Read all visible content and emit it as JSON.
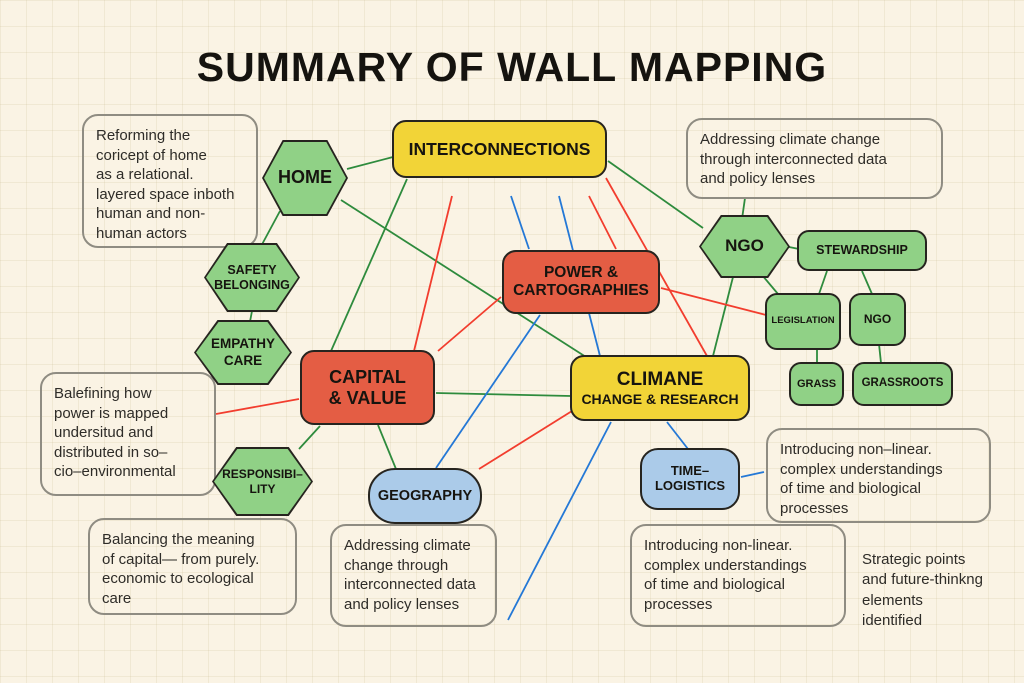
{
  "title": "SUMMARY OF WALL MAPPING",
  "colors": {
    "background": "#faf3e4",
    "node_yellow": "#f2d437",
    "node_red": "#e45d44",
    "node_green": "#90d186",
    "node_blue": "#abcbe9",
    "line_green": "#2e8b3d",
    "line_red": "#f23d2e",
    "line_blue": "#2478d6",
    "note_border": "#8f8c82",
    "text": "#16140f"
  },
  "nodes": {
    "interconnections": {
      "label": "INTERCONNECTIONS",
      "type": "yellow"
    },
    "home": {
      "label": "HOME",
      "type": "green-hexagon"
    },
    "safety_belonging": {
      "label": "SAFETY\nBELONGING",
      "type": "green-hexagon"
    },
    "empathy_care": {
      "label": "EMPATHY\nCARE",
      "type": "green-hexagon"
    },
    "ngo": {
      "label": "NGO",
      "type": "green-hexagon"
    },
    "responsibility": {
      "label": "RESPONSIBI–\nLITY",
      "type": "green-hexagon"
    },
    "power_cartographies": {
      "label": "POWER &\nCARTOGRAPHIES",
      "type": "red"
    },
    "capital_value": {
      "label": "CAPITAL\n& VALUE",
      "type": "red"
    },
    "climane": {
      "label": "CLIMANE",
      "sublabel": "CHANGE & RESEARCH",
      "type": "yellow"
    },
    "stewardship": {
      "label": "STEWARDSHIP",
      "type": "green-rect"
    },
    "legislation": {
      "label": "LEGISLATION",
      "type": "green-rect"
    },
    "ngo_small": {
      "label": "NGO",
      "type": "green-rect"
    },
    "grass": {
      "label": "GRASS",
      "type": "green-rect"
    },
    "grassroots": {
      "label": "GRASSROOTS",
      "type": "green-rect"
    },
    "geography": {
      "label": "GEOGRAPHY",
      "type": "blue"
    },
    "time_logistics": {
      "label": "TIME–\nLOGISTICS",
      "type": "blue"
    }
  },
  "notes": {
    "reforming": {
      "text": "Reforming the\ncoricept of home\nas a relational.\nlayered space inboth\nhuman and non-\nhuman actors"
    },
    "addressing_top": {
      "text": "Addressing climate change\nthrough interconnected data\nand policy lenses"
    },
    "balefining": {
      "text": "Balefining how\npower is mapped\nundersitud  and\ndistributed in so–\ncio–environmental"
    },
    "balancing": {
      "text": "Balancing the meaning\nof capital— from purely.\neconomic to ecological\ncare"
    },
    "addressing_bottom": {
      "text": "Addressing climate\nchange through\ninterconnected data\nand policy lenses"
    },
    "introducing_right": {
      "text": "Introducing non–linear.\ncomplex understandings\nof time and biological\nprocesses"
    },
    "introducing_bottom": {
      "text": "Introducing non-linear.\ncomplex understandings\nof time and biological\nprocesses"
    },
    "strategic": {
      "text": "Strategic points\nand future-thinkng\nelements\nidentified"
    }
  },
  "edges": [
    {
      "from": "home",
      "to": "interconnections",
      "color": "green",
      "x1": 347,
      "y1": 169,
      "x2": 393,
      "y2": 157
    },
    {
      "from": "home",
      "to": "safety_belonging",
      "color": "green",
      "x1": 280,
      "y1": 211,
      "x2": 259,
      "y2": 250
    },
    {
      "from": "safety_belonging",
      "to": "empathy_care",
      "color": "green",
      "x1": 252,
      "y1": 311,
      "x2": 249,
      "y2": 327
    },
    {
      "from": "home",
      "to": "climane",
      "color": "green",
      "x1": 341,
      "y1": 200,
      "x2": 586,
      "y2": 357
    },
    {
      "from": "interconnections",
      "to": "capital_value",
      "color": "green",
      "x1": 407,
      "y1": 179,
      "x2": 331,
      "y2": 351
    },
    {
      "from": "interconnections",
      "to": "ngo",
      "color": "green",
      "x1": 608,
      "y1": 161,
      "x2": 703,
      "y2": 228
    },
    {
      "from": "addressing_top_note",
      "to": "ngo",
      "color": "green",
      "x1": 745,
      "y1": 198,
      "x2": 742,
      "y2": 219
    },
    {
      "from": "ngo",
      "to": "stewardship",
      "color": "green",
      "x1": 789,
      "y1": 247,
      "x2": 799,
      "y2": 249
    },
    {
      "from": "ngo",
      "to": "climane",
      "color": "green",
      "x1": 733,
      "y1": 277,
      "x2": 713,
      "y2": 356
    },
    {
      "from": "ngo",
      "to": "legislation",
      "color": "green",
      "x1": 762,
      "y1": 275,
      "x2": 778,
      "y2": 294
    },
    {
      "from": "stewardship",
      "to": "legislation",
      "color": "green",
      "x1": 827,
      "y1": 271,
      "x2": 819,
      "y2": 294
    },
    {
      "from": "stewardship",
      "to": "ngo_small",
      "color": "green",
      "x1": 862,
      "y1": 271,
      "x2": 872,
      "y2": 294
    },
    {
      "from": "legislation",
      "to": "grass",
      "color": "green",
      "x1": 817,
      "y1": 349,
      "x2": 817,
      "y2": 363
    },
    {
      "from": "ngo_small",
      "to": "grassroots",
      "color": "green",
      "x1": 879,
      "y1": 344,
      "x2": 881,
      "y2": 363
    },
    {
      "from": "responsibility",
      "to": "capital_value",
      "color": "green",
      "x1": 299,
      "y1": 449,
      "x2": 320,
      "y2": 426
    },
    {
      "from": "capital_value",
      "to": "geography",
      "color": "green",
      "x1": 378,
      "y1": 425,
      "x2": 396,
      "y2": 469
    },
    {
      "from": "capital_value",
      "to": "climane",
      "color": "green",
      "x1": 436,
      "y1": 393,
      "x2": 571,
      "y2": 396
    },
    {
      "from": "interconnections",
      "to": "capital_value",
      "color": "red",
      "x1": 452,
      "y1": 196,
      "x2": 414,
      "y2": 351
    },
    {
      "from": "interconnections",
      "to": "power_cartographies",
      "color": "red",
      "x1": 589,
      "y1": 196,
      "x2": 616,
      "y2": 249
    },
    {
      "from": "interconnections",
      "to": "climane",
      "color": "red",
      "x1": 606,
      "y1": 178,
      "x2": 707,
      "y2": 356
    },
    {
      "from": "power_cartographies",
      "to": "legislation",
      "color": "red",
      "x1": 661,
      "y1": 288,
      "x2": 766,
      "y2": 315
    },
    {
      "from": "capital_value",
      "to": "power_cartographies",
      "color": "red",
      "x1": 438,
      "y1": 351,
      "x2": 501,
      "y2": 297
    },
    {
      "from": "geography",
      "to": "climane",
      "color": "red",
      "x1": 479,
      "y1": 469,
      "x2": 572,
      "y2": 411
    },
    {
      "from": "balefining_note",
      "to": "capital_value",
      "color": "red",
      "x1": 216,
      "y1": 414,
      "x2": 299,
      "y2": 399
    },
    {
      "from": "interconnections",
      "to": "power_cartographies",
      "color": "blue",
      "x1": 511,
      "y1": 196,
      "x2": 529,
      "y2": 249
    },
    {
      "from": "interconnections",
      "to": "climane",
      "color": "blue",
      "x1": 559,
      "y1": 196,
      "x2": 600,
      "y2": 356
    },
    {
      "from": "power_cartographies",
      "to": "geography",
      "color": "blue",
      "x1": 540,
      "y1": 315,
      "x2": 436,
      "y2": 468
    },
    {
      "from": "climane",
      "to": "time_logistics",
      "color": "blue",
      "x1": 667,
      "y1": 422,
      "x2": 688,
      "y2": 449
    },
    {
      "from": "time_logistics",
      "to": "introducing_right_note",
      "color": "blue",
      "x1": 741,
      "y1": 477,
      "x2": 764,
      "y2": 472
    },
    {
      "from": "climane",
      "to": "addressing_bottom_note",
      "color": "blue",
      "x1": 611,
      "y1": 422,
      "x2": 508,
      "y2": 620
    }
  ]
}
